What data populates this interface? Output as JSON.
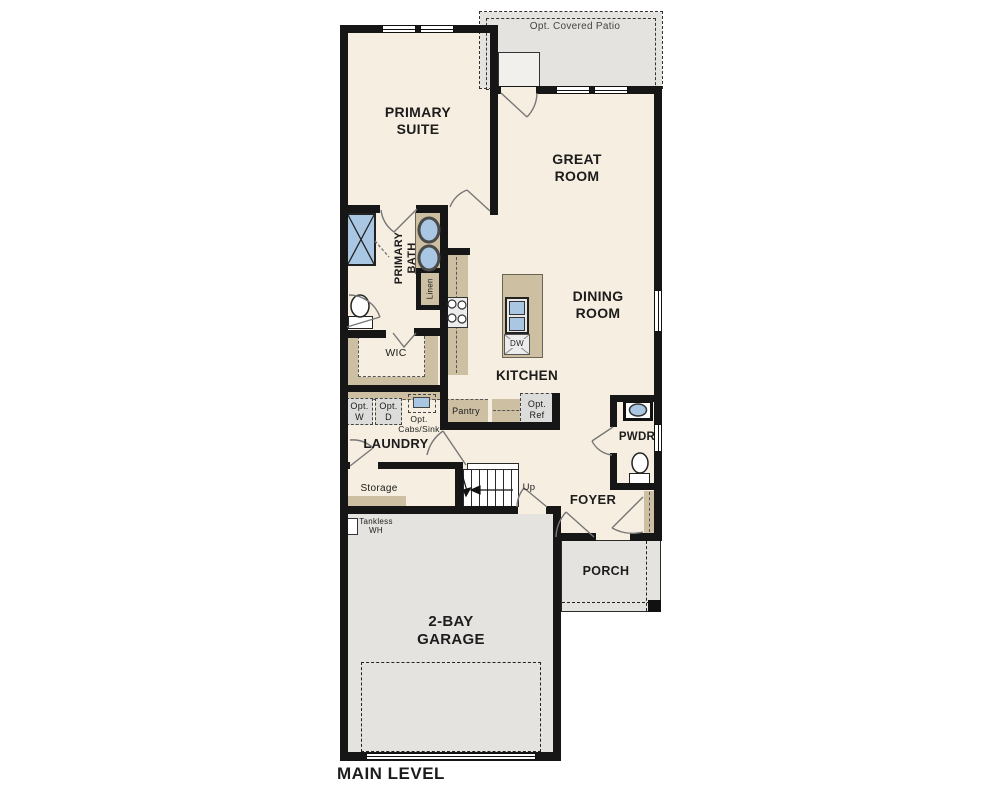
{
  "title": {
    "main_level": "MAIN LEVEL"
  },
  "colors": {
    "wall": "#161616",
    "floor_cream": "#f6eee0",
    "floor_gray": "#e4e3e0",
    "cabinet_tan": "#cdbfa2",
    "fixture_blue": "#a9c7e3"
  },
  "rooms": {
    "patio": "Opt. Covered Patio",
    "primary_suite": "PRIMARY SUITE",
    "great_room": "GREAT ROOM",
    "dining_room": "DINING ROOM",
    "primary_bath": "PRIMARY BATH",
    "linen": "Linen",
    "wic": "WIC",
    "kitchen": "KITCHEN",
    "pantry": "Pantry",
    "laundry": "LAUNDRY",
    "storage": "Storage",
    "foyer": "FOYER",
    "pwdr": "PWDR",
    "porch": "PORCH",
    "garage": "2-BAY GARAGE"
  },
  "annotations": {
    "opt_w": "Opt. W",
    "opt_d": "Opt. D",
    "opt_cabs_sink": "Opt. Cabs/Sink",
    "opt_ref": "Opt. Ref",
    "tankless_wh": "Tankless WH",
    "up": "Up",
    "dw": "DW"
  }
}
